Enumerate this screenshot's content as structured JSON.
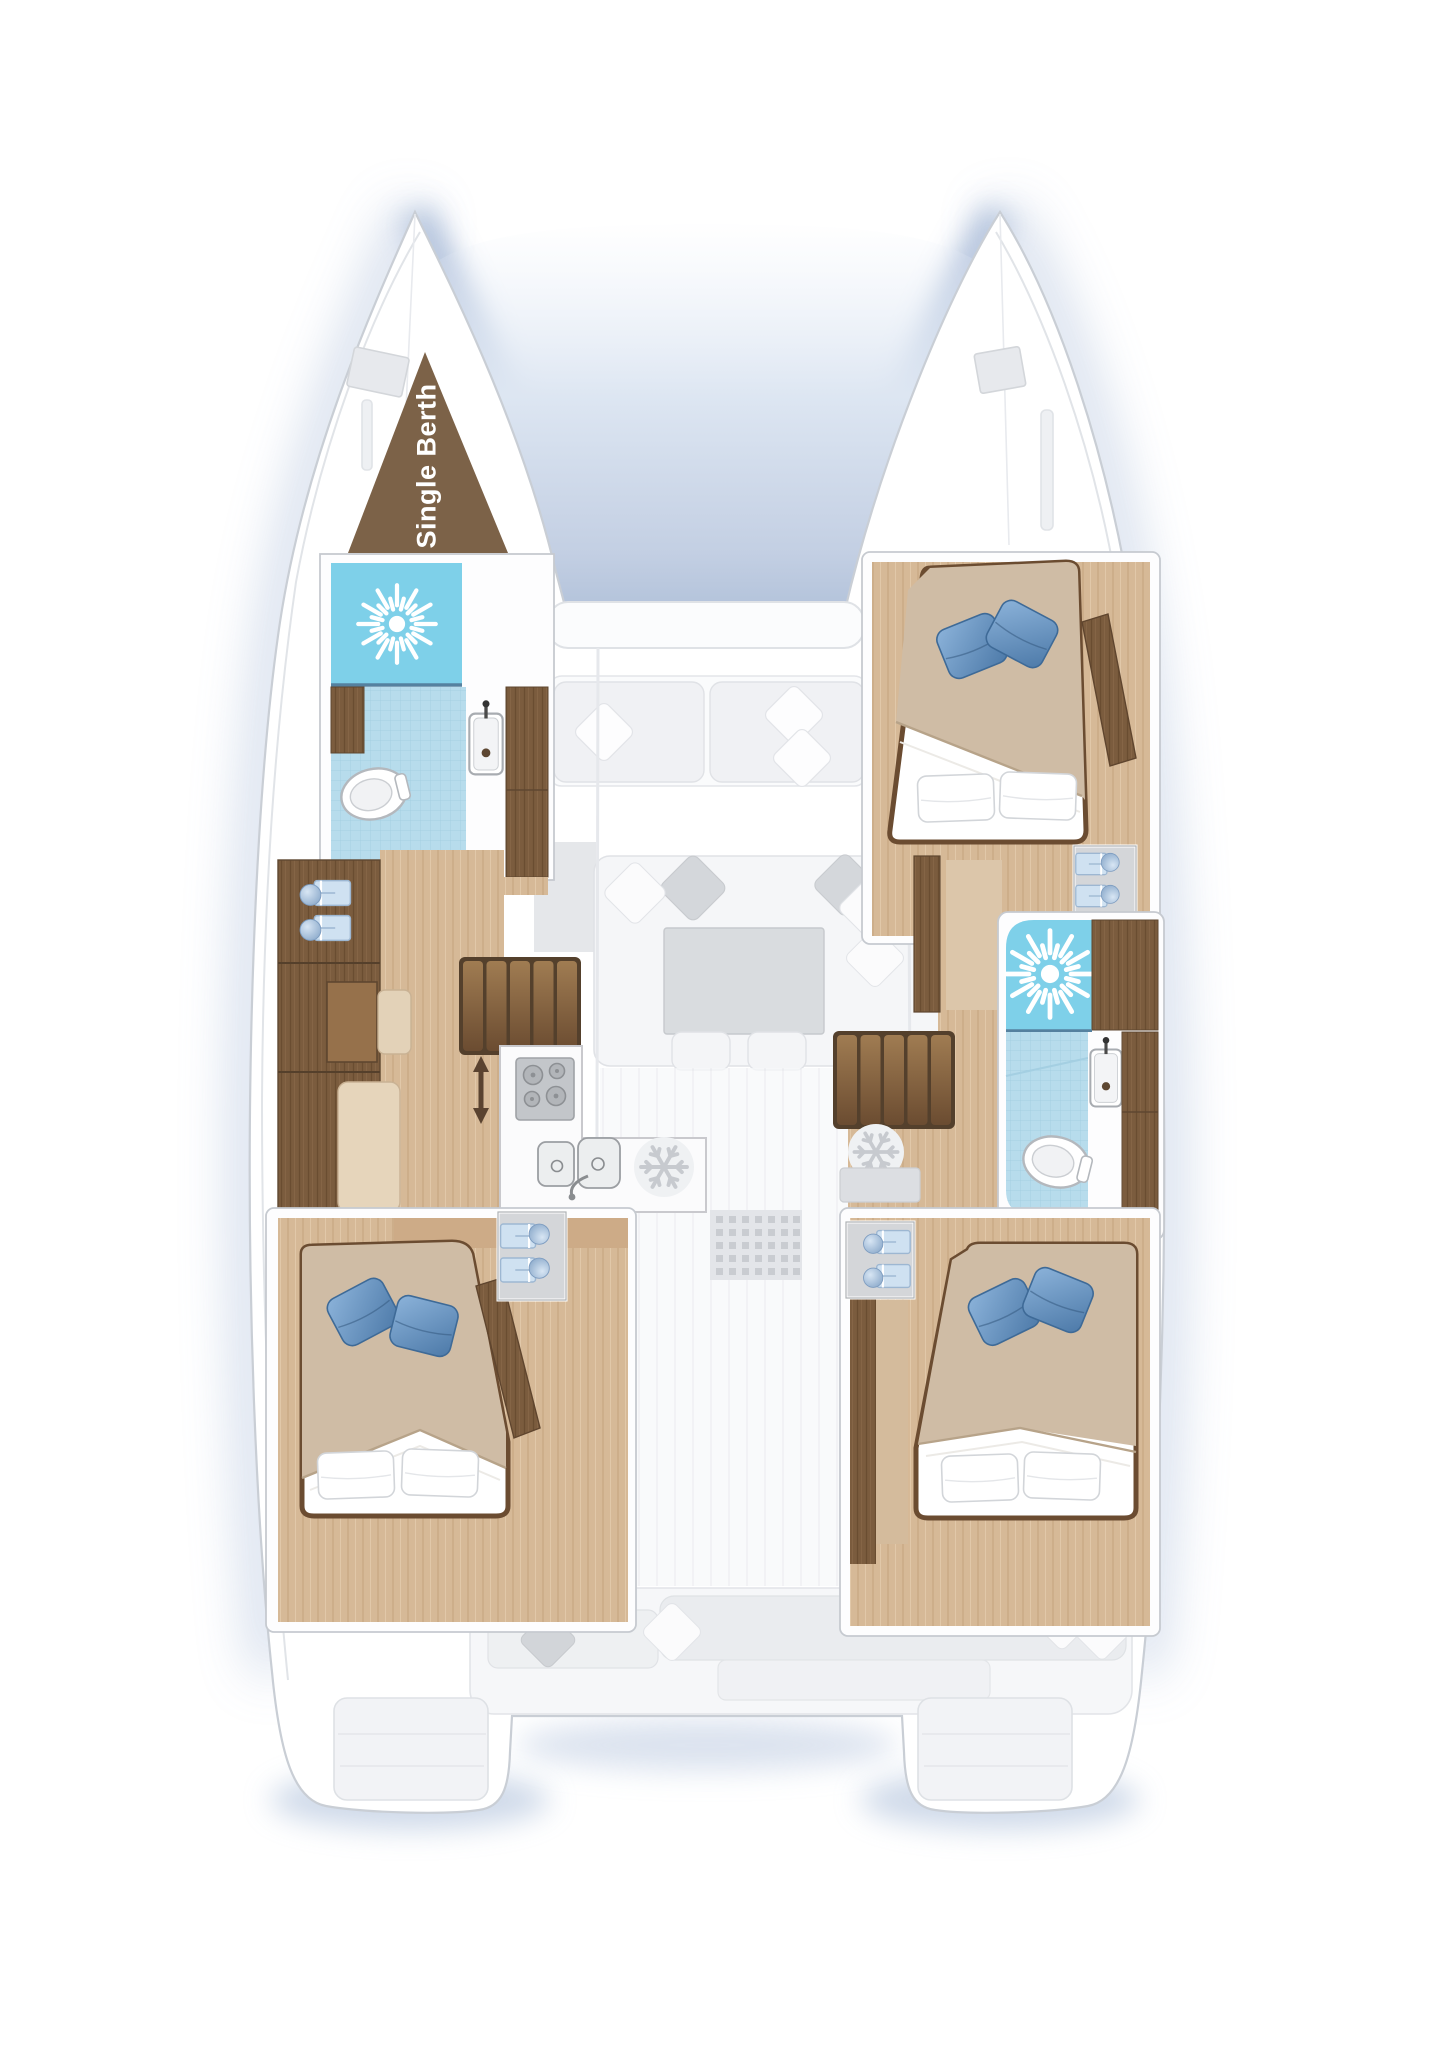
{
  "floorplan": {
    "boat_type": "sailing catamaran",
    "view": "top-down interior deck plan",
    "labels": {
      "single_berth": "Single Berth"
    },
    "colors": {
      "background": "#ffffff",
      "hull_shadow_glow": "#b6c6de",
      "hull_fill": "#ffffff",
      "hull_outline": "#c9ced5",
      "ghost_furniture_fill": "#eef0f3",
      "ghost_furniture_stroke": "#dfe2e6",
      "wood_dark_cabinet": "#7b5c3e",
      "wood_medium": "#96714b",
      "wood_floor_light": "#d6b997",
      "single_berth_brown": "#7c6248",
      "shower_blue": "#7ed0e9",
      "bathroom_tile_blue": "#b7dcec",
      "pillow_blue": "#6f9ecb",
      "bed_linen_beige": "#cfbca5",
      "linen_white": "#ffffff",
      "appliance_gray": "#c3c6ca",
      "companionway_arrow_brown": "#5a4330"
    },
    "icons": [
      {
        "name": "shower-icon",
        "meaning": "shower head sunburst",
        "count": 2
      },
      {
        "name": "toilet-icon",
        "meaning": "marine toilet",
        "count": 2
      },
      {
        "name": "washbasin-icon",
        "meaning": "washbasin with faucet",
        "count": 2
      },
      {
        "name": "stove-icon",
        "meaning": "4-burner cooktop",
        "count": 1
      },
      {
        "name": "double-sink-icon",
        "meaning": "galley twin sink",
        "count": 1
      },
      {
        "name": "fridge-icon",
        "meaning": "refrigerator snowflake",
        "count": 2
      },
      {
        "name": "companionway-arrow-icon",
        "meaning": "up-down companionway arrow",
        "count": 1
      },
      {
        "name": "stairs-icon",
        "meaning": "companionway steps",
        "count": 2
      },
      {
        "name": "double-bed",
        "meaning": "double berth with blue and white pillows",
        "count": 3
      },
      {
        "name": "step-box-icon",
        "meaning": "entry step with cushion",
        "count": 8
      }
    ]
  }
}
